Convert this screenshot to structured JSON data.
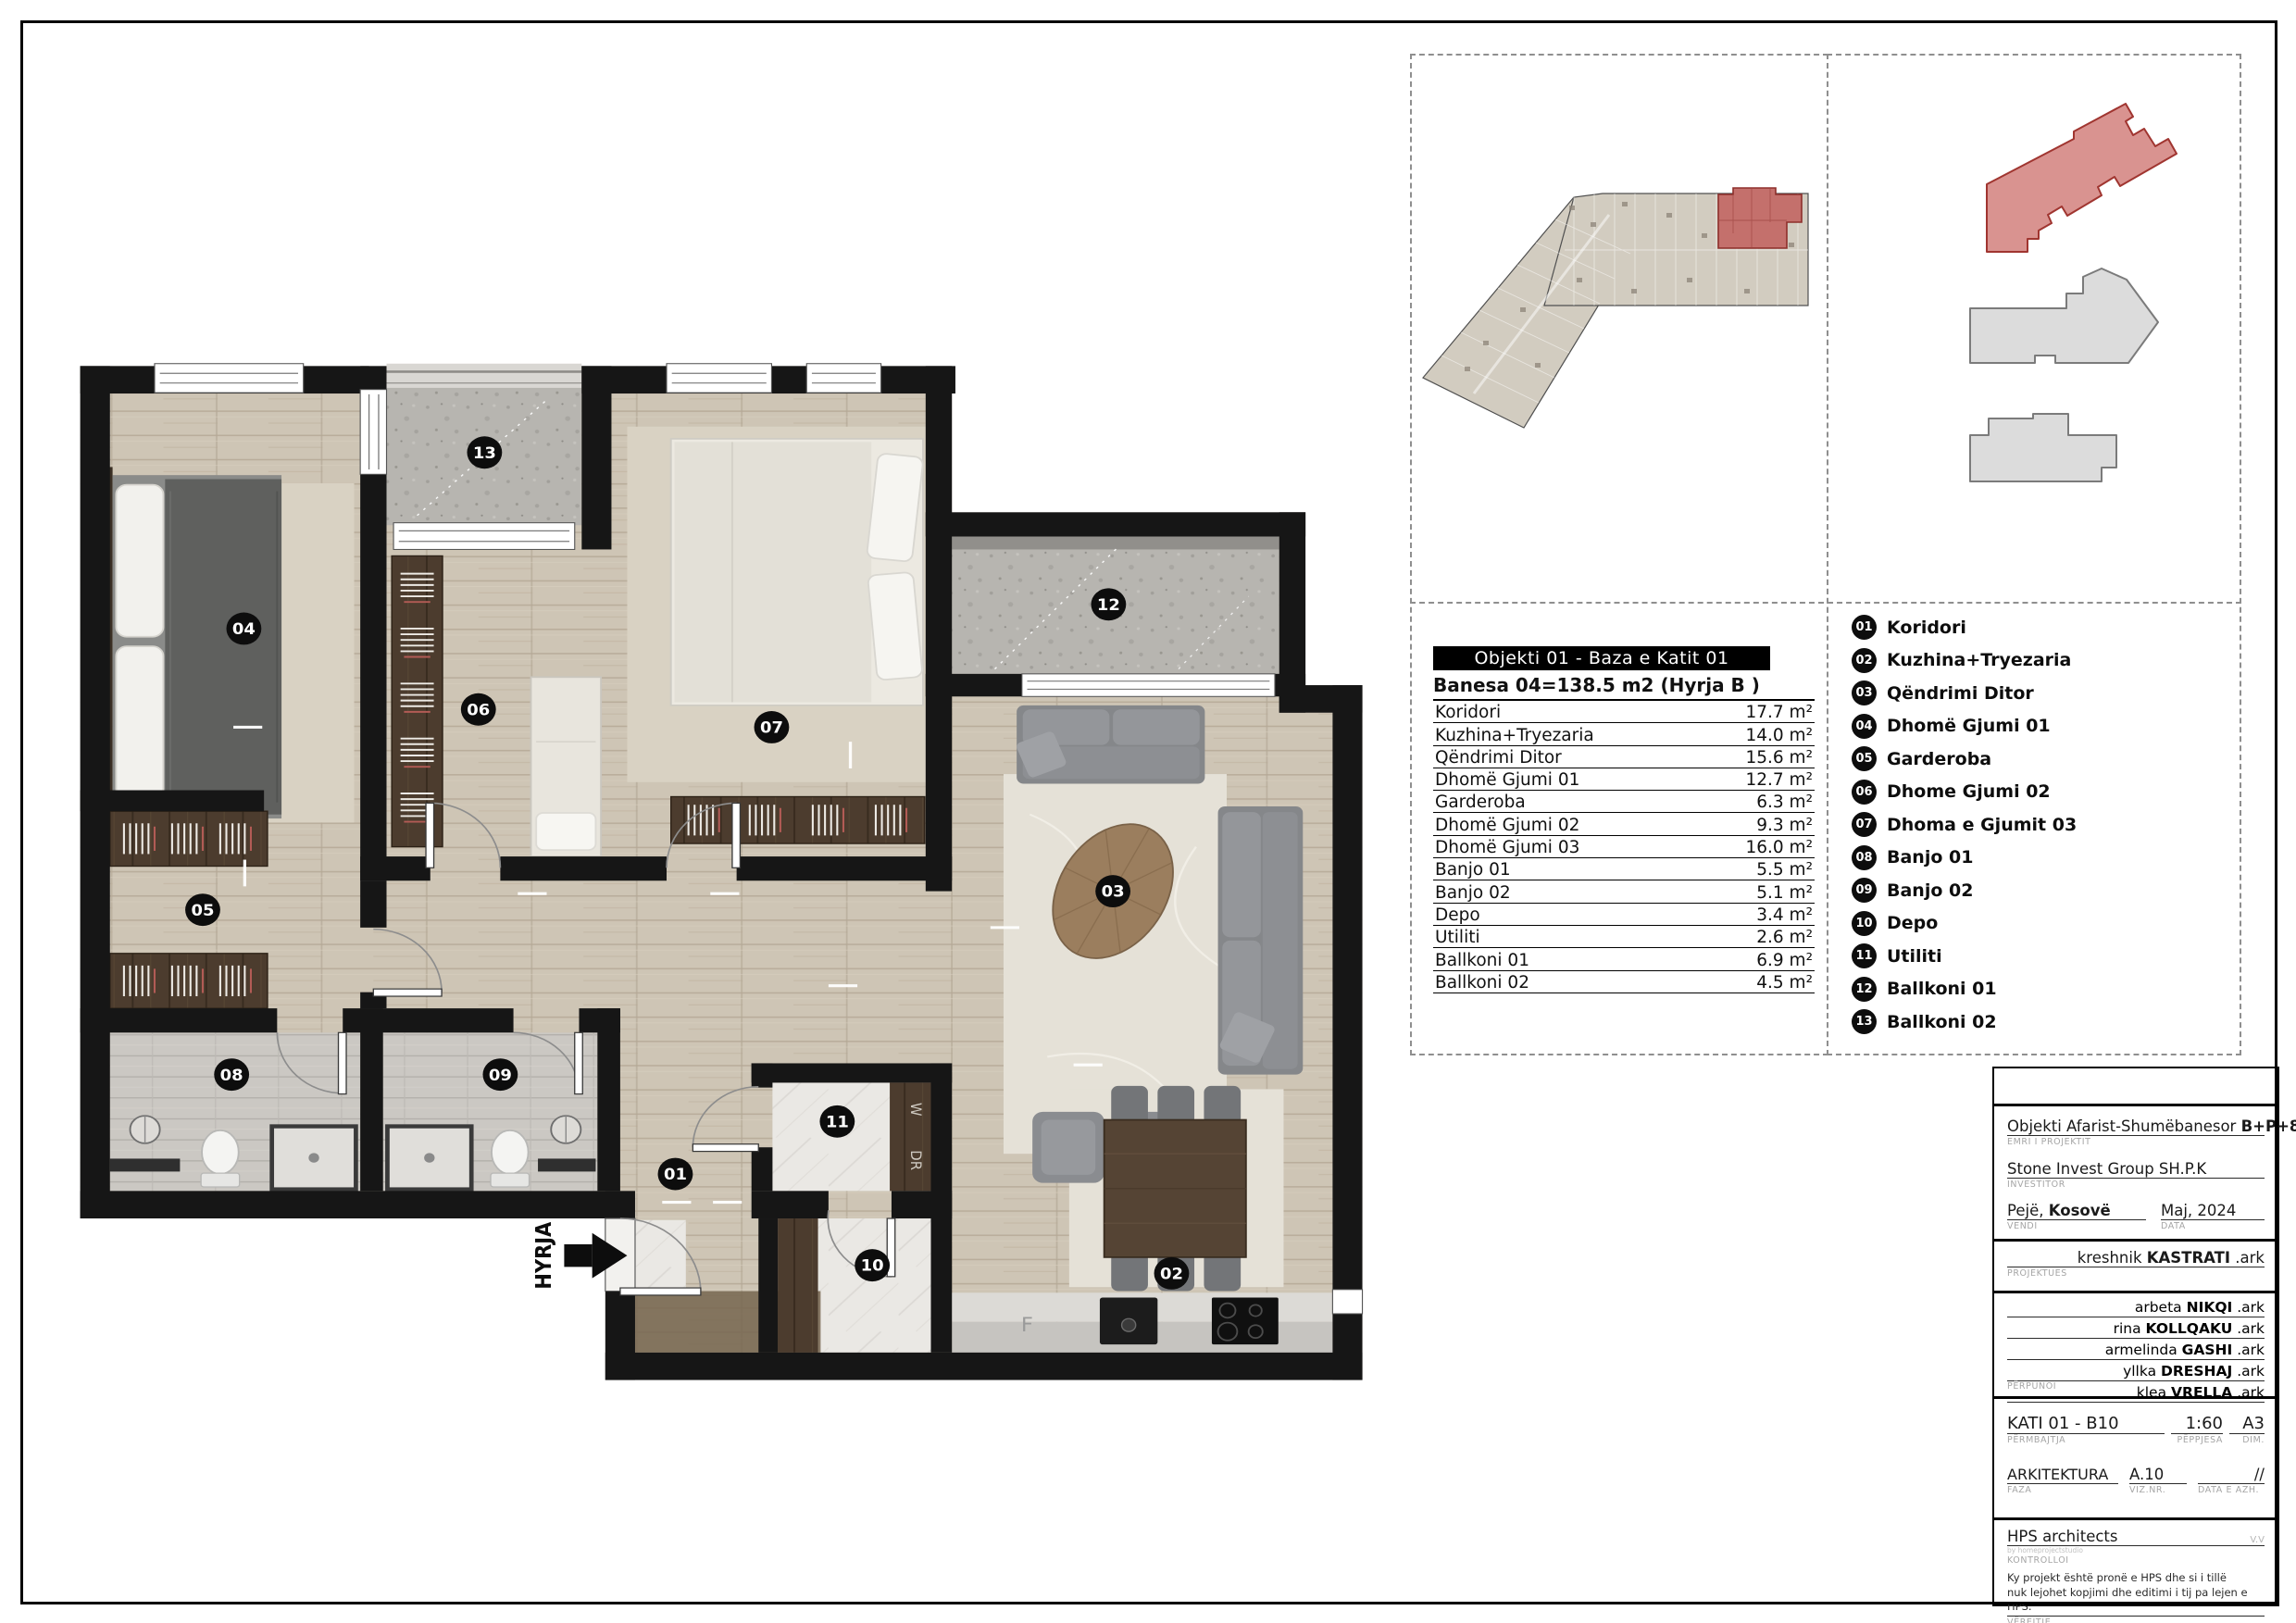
{
  "area_table": {
    "title": "Objekti 01 - Baza e Katit 01",
    "subtitle": "Banesa 04=138.5 m2 (Hyrja B )",
    "rows": [
      {
        "name": "Koridori",
        "area": "17.7 m²"
      },
      {
        "name": "Kuzhina+Tryezaria",
        "area": "14.0 m²"
      },
      {
        "name": "Qëndrimi Ditor",
        "area": "15.6 m²"
      },
      {
        "name": "Dhomë Gjumi 01",
        "area": "12.7 m²"
      },
      {
        "name": "Garderoba",
        "area": "6.3 m²"
      },
      {
        "name": "Dhomë Gjumi 02",
        "area": "9.3 m²"
      },
      {
        "name": "Dhomë Gjumi 03",
        "area": "16.0 m²"
      },
      {
        "name": "Banjo 01",
        "area": "5.5 m²"
      },
      {
        "name": "Banjo 02",
        "area": "5.1 m²"
      },
      {
        "name": "Depo",
        "area": "3.4 m²"
      },
      {
        "name": "Utiliti",
        "area": "2.6 m²"
      },
      {
        "name": "Ballkoni 01",
        "area": "6.9 m²"
      },
      {
        "name": "Ballkoni 02",
        "area": "4.5 m²"
      }
    ]
  },
  "legend": {
    "items": [
      {
        "num": "01",
        "label": "Koridori"
      },
      {
        "num": "02",
        "label": "Kuzhina+Tryezaria"
      },
      {
        "num": "03",
        "label": "Qëndrimi Ditor"
      },
      {
        "num": "04",
        "label": "Dhomë Gjumi 01"
      },
      {
        "num": "05",
        "label": "Garderoba"
      },
      {
        "num": "06",
        "label": "Dhome Gjumi 02"
      },
      {
        "num": "07",
        "label": "Dhoma e Gjumit 03"
      },
      {
        "num": "08",
        "label": "Banjo 01"
      },
      {
        "num": "09",
        "label": "Banjo 02"
      },
      {
        "num": "10",
        "label": "Depo"
      },
      {
        "num": "11",
        "label": "Utiliti"
      },
      {
        "num": "12",
        "label": "Ballkoni 01"
      },
      {
        "num": "13",
        "label": "Ballkoni 02"
      }
    ]
  },
  "plan_labels": {
    "entrance": "HYRJA",
    "washer": "W",
    "dryer": "DR",
    "fridge": "F"
  },
  "titleblock": {
    "project_name": "Objekti Afarist-Shumëbanesor",
    "project_name_bold": "B+P+8K",
    "project_label": "EMRI I PROJEKTIT",
    "investor": "Stone Invest Group SH.P.K",
    "investor_label": "INVESTITOR",
    "place": "Pejë,",
    "place_bold": "Kosovë",
    "place_label": "VENDI",
    "date": "Maj, 2024",
    "date_label": "DATA",
    "designer_first": "kreshnik",
    "designer_last": "KASTRATI",
    "designer_suffix": ".ark",
    "designer_label": "PROJEKTUES",
    "staff_label": "PËRPUNOI",
    "staff": [
      {
        "first": "arbeta",
        "last": "NIKQI",
        "suffix": ".ark"
      },
      {
        "first": "rina",
        "last": "KOLLQAKU",
        "suffix": ".ark"
      },
      {
        "first": "armelinda",
        "last": "GASHI",
        "suffix": ".ark"
      },
      {
        "first": "yllka",
        "last": "DRESHAJ",
        "suffix": ".ark"
      },
      {
        "first": "klea",
        "last": "VRELLA",
        "suffix": ".ark"
      }
    ],
    "content_value": "KATI 01 - B10",
    "content_label": "PËRMBAJTJA",
    "scale_value": "1:60",
    "scale_label": "PËPPJESA",
    "size_value": "A3",
    "size_label": "DIM.",
    "phase_value": "ARKITEKTURA",
    "phase_label": "FAZA",
    "sheet_no": "A.10",
    "sheet_no_label": "VIZ.NR.",
    "update_value": "//",
    "update_label": "DATA E AZH.",
    "checker": "HPS architects",
    "checker_sub": "by homeprojectstudio",
    "checker_label": "KONTROLLOI",
    "checker_initials": "V.V",
    "note_line1": "Ky projekt është pronë e HPS dhe si i tillë",
    "note_line2": "nuk lejohet kopjimi dhe editimi i tij pa lejen e HPS.",
    "note_label": "VËREJTJE"
  },
  "colors": {
    "wall": "#161616",
    "highlight": "#c4706c",
    "badge": "#0d0d0d"
  }
}
